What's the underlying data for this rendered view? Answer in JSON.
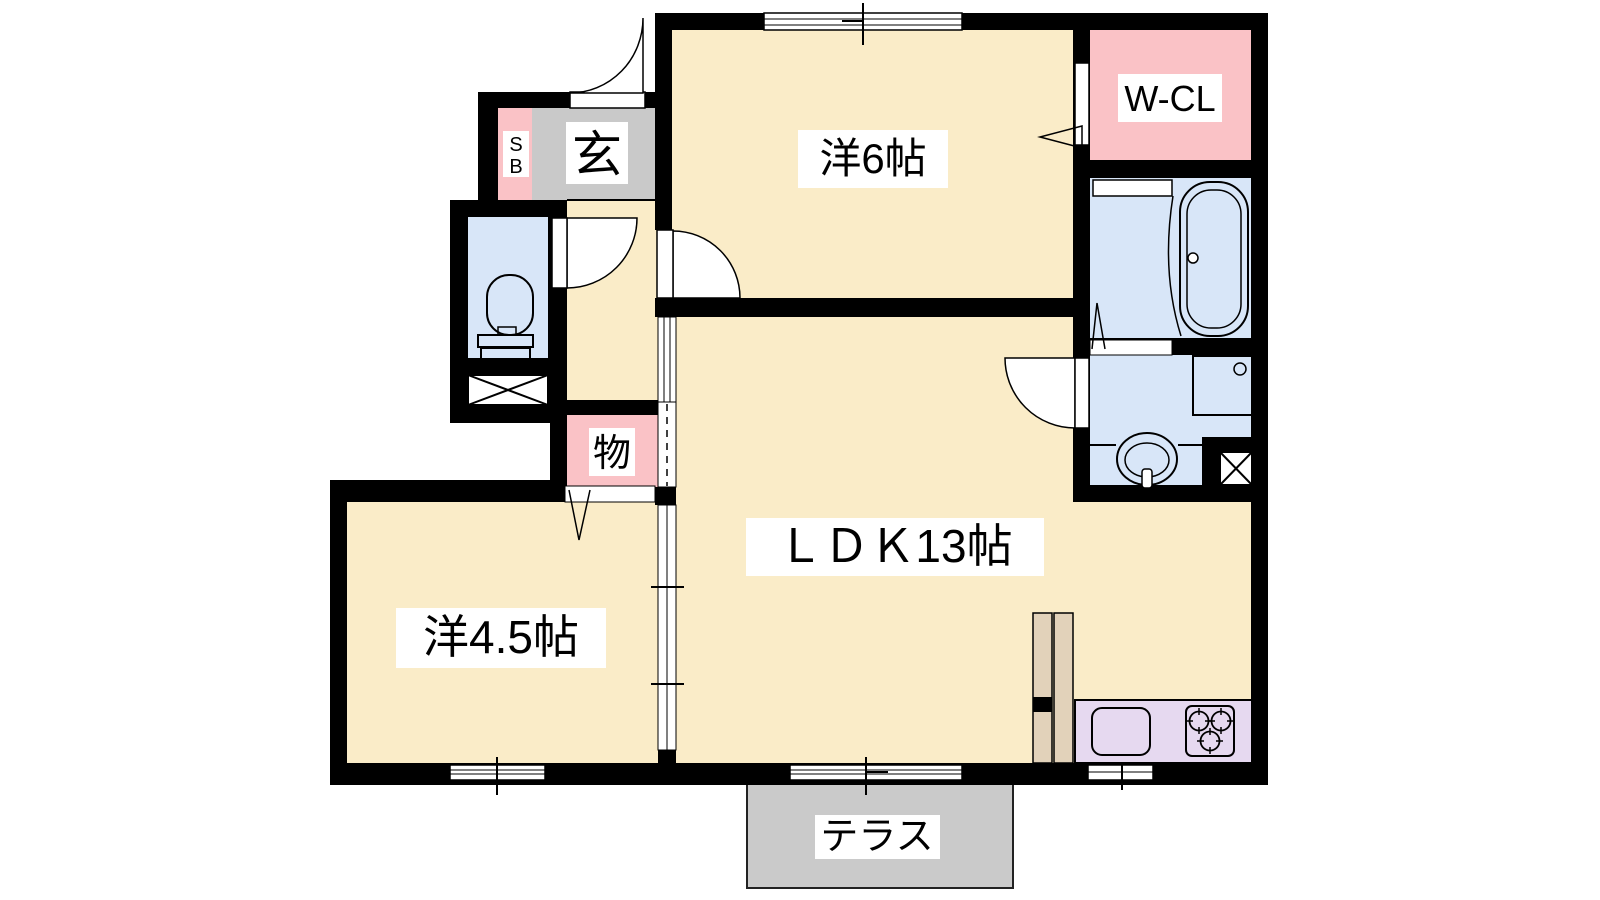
{
  "diagram_type": "japanese-apartment-floor-plan",
  "labels": {
    "bedroom6": "洋6帖",
    "walk_in_closet": "W-CL",
    "ldk": "ＬＤＫ13帖",
    "bedroom45": "洋4.5帖",
    "storage": "物",
    "entrance": "玄",
    "shoebox_line1": "S",
    "shoebox_line2": "B",
    "terrace": "テラス"
  },
  "rooms": [
    {
      "name": "western-room-6",
      "label": "洋6帖"
    },
    {
      "name": "walk-in-closet",
      "label": "W-CL"
    },
    {
      "name": "bathroom",
      "label": ""
    },
    {
      "name": "washroom",
      "label": ""
    },
    {
      "name": "toilet",
      "label": ""
    },
    {
      "name": "entrance-genkan",
      "label": "玄"
    },
    {
      "name": "shoe-box",
      "label": "SB"
    },
    {
      "name": "storage-closet",
      "label": "物"
    },
    {
      "name": "living-dining-kitchen-13",
      "label": "ＬＤＫ13帖"
    },
    {
      "name": "western-room-4-5",
      "label": "洋4.5帖"
    },
    {
      "name": "terrace",
      "label": "テラス"
    }
  ],
  "colors": {
    "room_floor_cream": "#FAECC8",
    "closet_pink": "#FAC2C6",
    "wet_area_blue": "#D8E6F8",
    "entrance_gray": "#C9C9C9",
    "terrace_gray": "#CACACA",
    "kitchen_lavender": "#E6D9F0",
    "cabinet_tan": "#E2D2BA",
    "wall_black": "#000000"
  }
}
